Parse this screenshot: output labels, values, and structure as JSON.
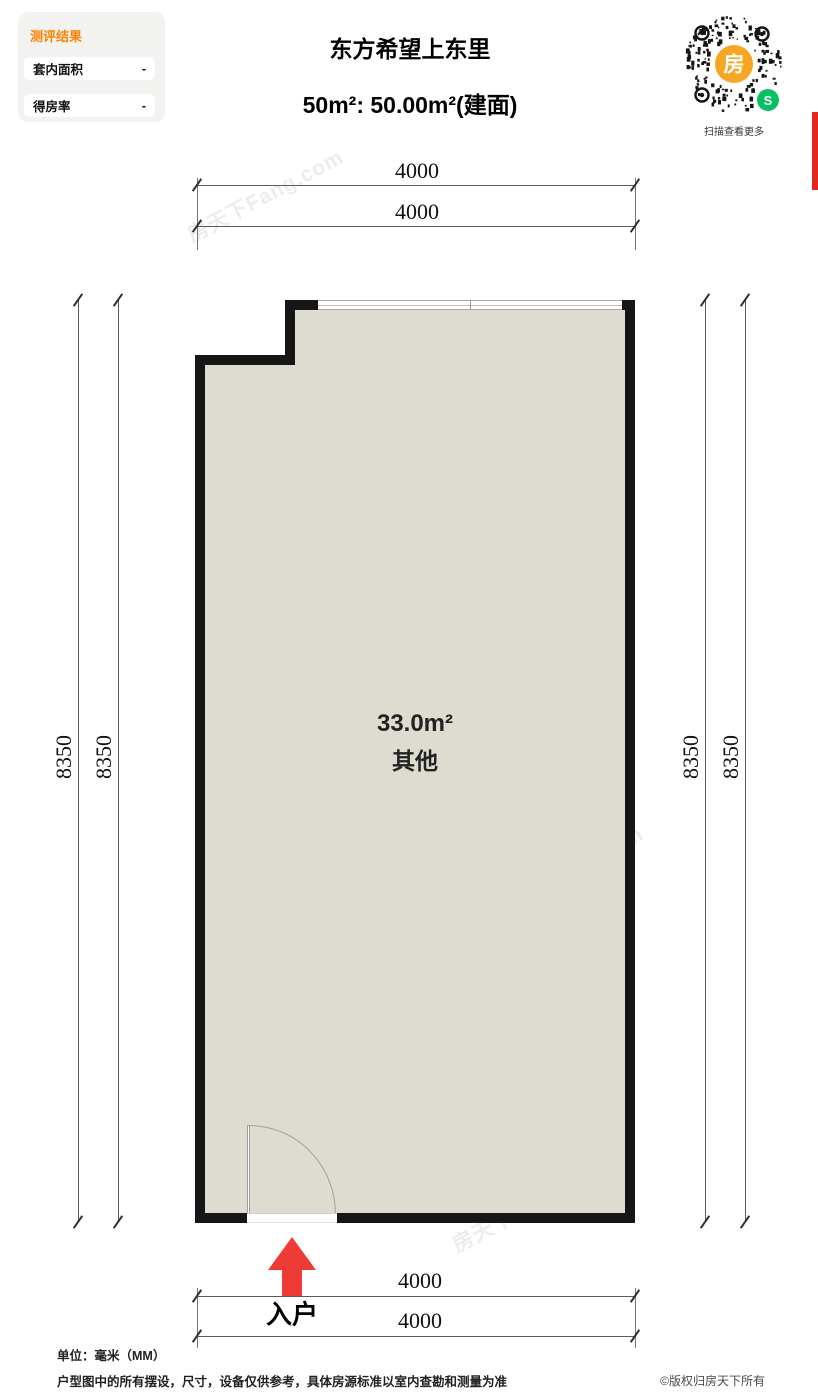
{
  "eval_panel": {
    "title": "测评结果",
    "rows": [
      {
        "label": "套内面积",
        "value": "-"
      },
      {
        "label": "得房率",
        "value": "-"
      }
    ]
  },
  "header": {
    "project_title": "东方希望上东里",
    "area_line": "50m²: 50.00m²(建面)"
  },
  "qr": {
    "center_char": "房",
    "logo_char": "S",
    "caption": "扫描查看更多"
  },
  "plan": {
    "room": {
      "area": "33.0m²",
      "name": "其他"
    },
    "dims": {
      "top": [
        "4000",
        "4000"
      ],
      "bottom": [
        "4000",
        "4000"
      ],
      "left": [
        "8350",
        "8350"
      ],
      "right": [
        "8350",
        "8350"
      ]
    },
    "entry_label": "入户"
  },
  "watermark_text": "房天下Fang.com",
  "footer": {
    "unit_note": "单位：毫米（MM）",
    "disclaimer": "户型图中的所有摆设，尺寸，设备仅供参考，具体房源标准以室内查勘和测量为准",
    "copyright": "©版权归房天下所有"
  },
  "colors": {
    "accent_orange": "#ff8200",
    "qr_orange": "#f6a623",
    "wechat_green": "#07c160",
    "arrow_red": "#ef3b36",
    "side_bar_red": "#e5261f",
    "room_fill": "#dedcd0",
    "wall": "#161616"
  }
}
